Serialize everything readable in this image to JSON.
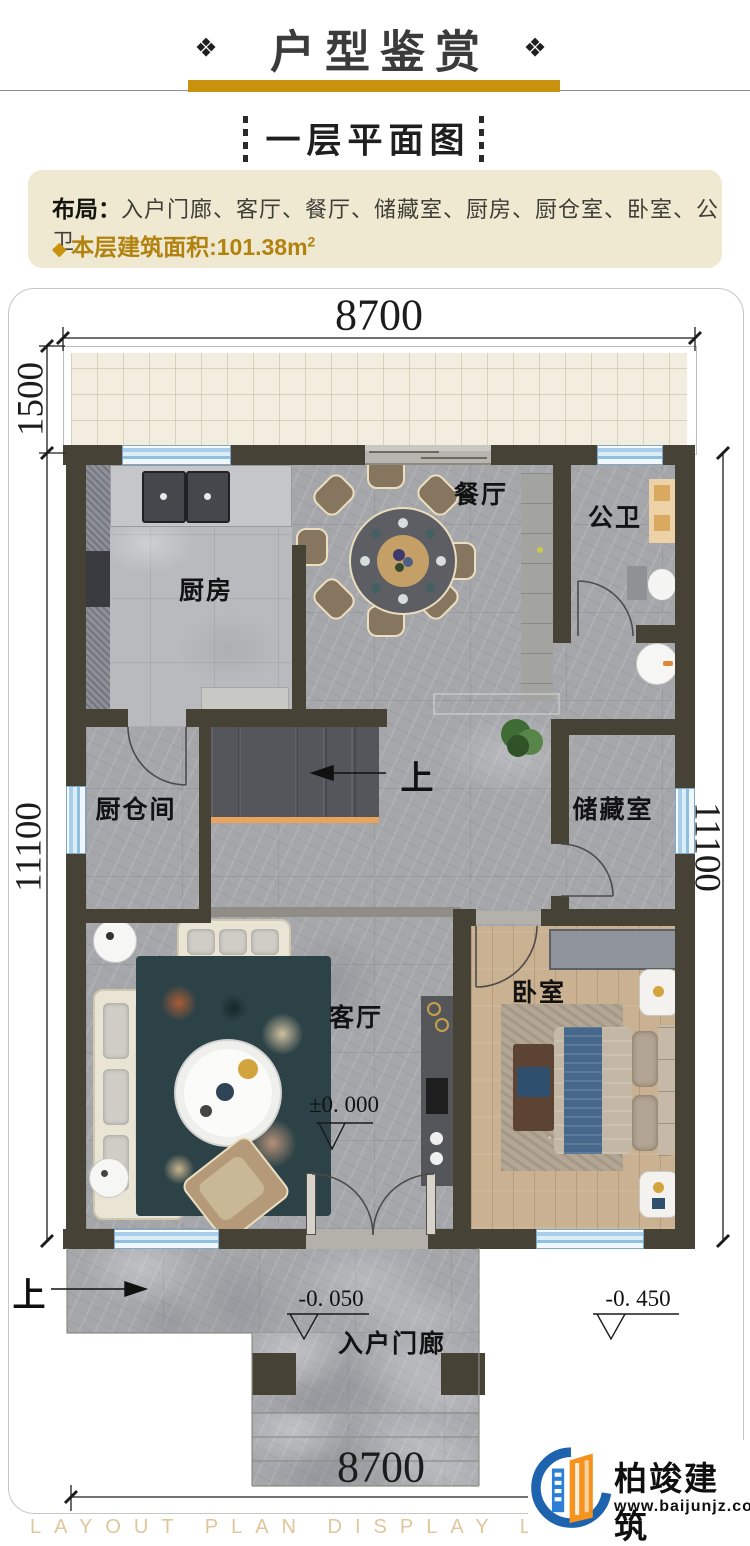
{
  "header": {
    "ornament_left": "❖",
    "title": "户型鉴赏",
    "ornament_right": "❖"
  },
  "subtitle": {
    "text": "一层平面图"
  },
  "info": {
    "layout_label": "布局：",
    "layout_value": "入户门廊、客厅、餐厅、储藏室、厨房、厨仓室、卧室、公卫",
    "area_bullet": "◆",
    "area_text": "本层建筑面积:101.38m",
    "area_sup": "2"
  },
  "plan": {
    "dimensions": {
      "top": "8700",
      "bottom": "8700",
      "left_upper": "1500",
      "left": "11100",
      "right": "11100"
    },
    "rooms": {
      "kitchen": "厨房",
      "dining": "餐厅",
      "bathroom": "公卫",
      "pantry": "厨仓间",
      "storage": "储藏室",
      "living": "客厅",
      "bedroom": "卧室",
      "porch": "入户门廊"
    },
    "stairs_up": "上",
    "porch_up": "上",
    "elevations": {
      "zero": "±0. 000",
      "minus_005": "-0. 050",
      "minus_045": "-0. 450"
    }
  },
  "footer": {
    "watermark": "LAYOUT PLAN DISPLAY LAYOUT PLAN DISPLAY",
    "brand": "柏竣建筑",
    "site": "www.baijunjz.com"
  },
  "colors": {
    "gold": "#c8920e",
    "info_bg": "#f0e9d2",
    "wall": "#474236",
    "window_blue": "#a8cfe9",
    "floor_gray": "#a6a7ab",
    "wood": "#c9b191",
    "stair_nosing": "#e8a35e",
    "watermark_tan": "#e0c69a",
    "brand_blue": "#1e63ad",
    "brand_orange": "#f6921e"
  }
}
